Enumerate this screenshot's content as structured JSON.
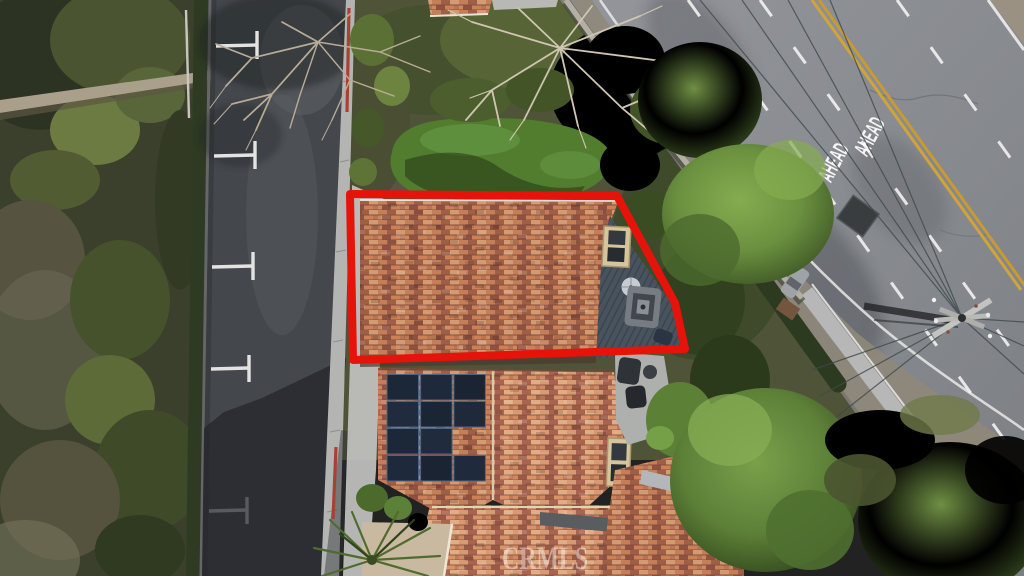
{
  "scene": {
    "type": "aerial-drone-photo",
    "description": "Overhead aerial view of a tile-roof residential property; a red polygon outlines the upper roof and roof deck. A small residential street with T parking markings runs along the left, a major curved road with painted AHEAD markings and a utility pole runs along the upper right, dense vegetation elsewhere.",
    "watermark_text": "CRMLS",
    "road_text_left": "AHEAD",
    "road_text_right": "AHEAD",
    "highlight_color": "#e6130b",
    "palette": {
      "street_asphalt": "#44474c",
      "main_road": "#898c91",
      "double_yellow": "#cfa43d",
      "lane_white": "#f2f2f2",
      "roof_tile": "#b26a4c",
      "solar_panel": "#1c2737",
      "deck": "#49535d",
      "lawn": "#527c2e",
      "hillside": "#3b402c",
      "red_curb": "#a84135",
      "sidewalk": "#b4b5b3"
    },
    "objects": {
      "left": "hillside brush, dirt path, hedge and curb",
      "street": "residential street with five white T parking stall markings, red curb segments, sidewalk, house shadow",
      "center": "artificial lawn, bare deciduous trees, shrubs, garden wall",
      "house": "tile roofs, roof deck with patio set and umbrella, two dormer skylights, 11 solar panels, palm tree, courtyard",
      "road": "two AHEAD pavement legends, double yellow centerline, white lane lines, utility pole with crossarms and power lines, tree shadows, dark utility patch",
      "bottom_right": "large green tree canopies and scrub slope"
    }
  }
}
